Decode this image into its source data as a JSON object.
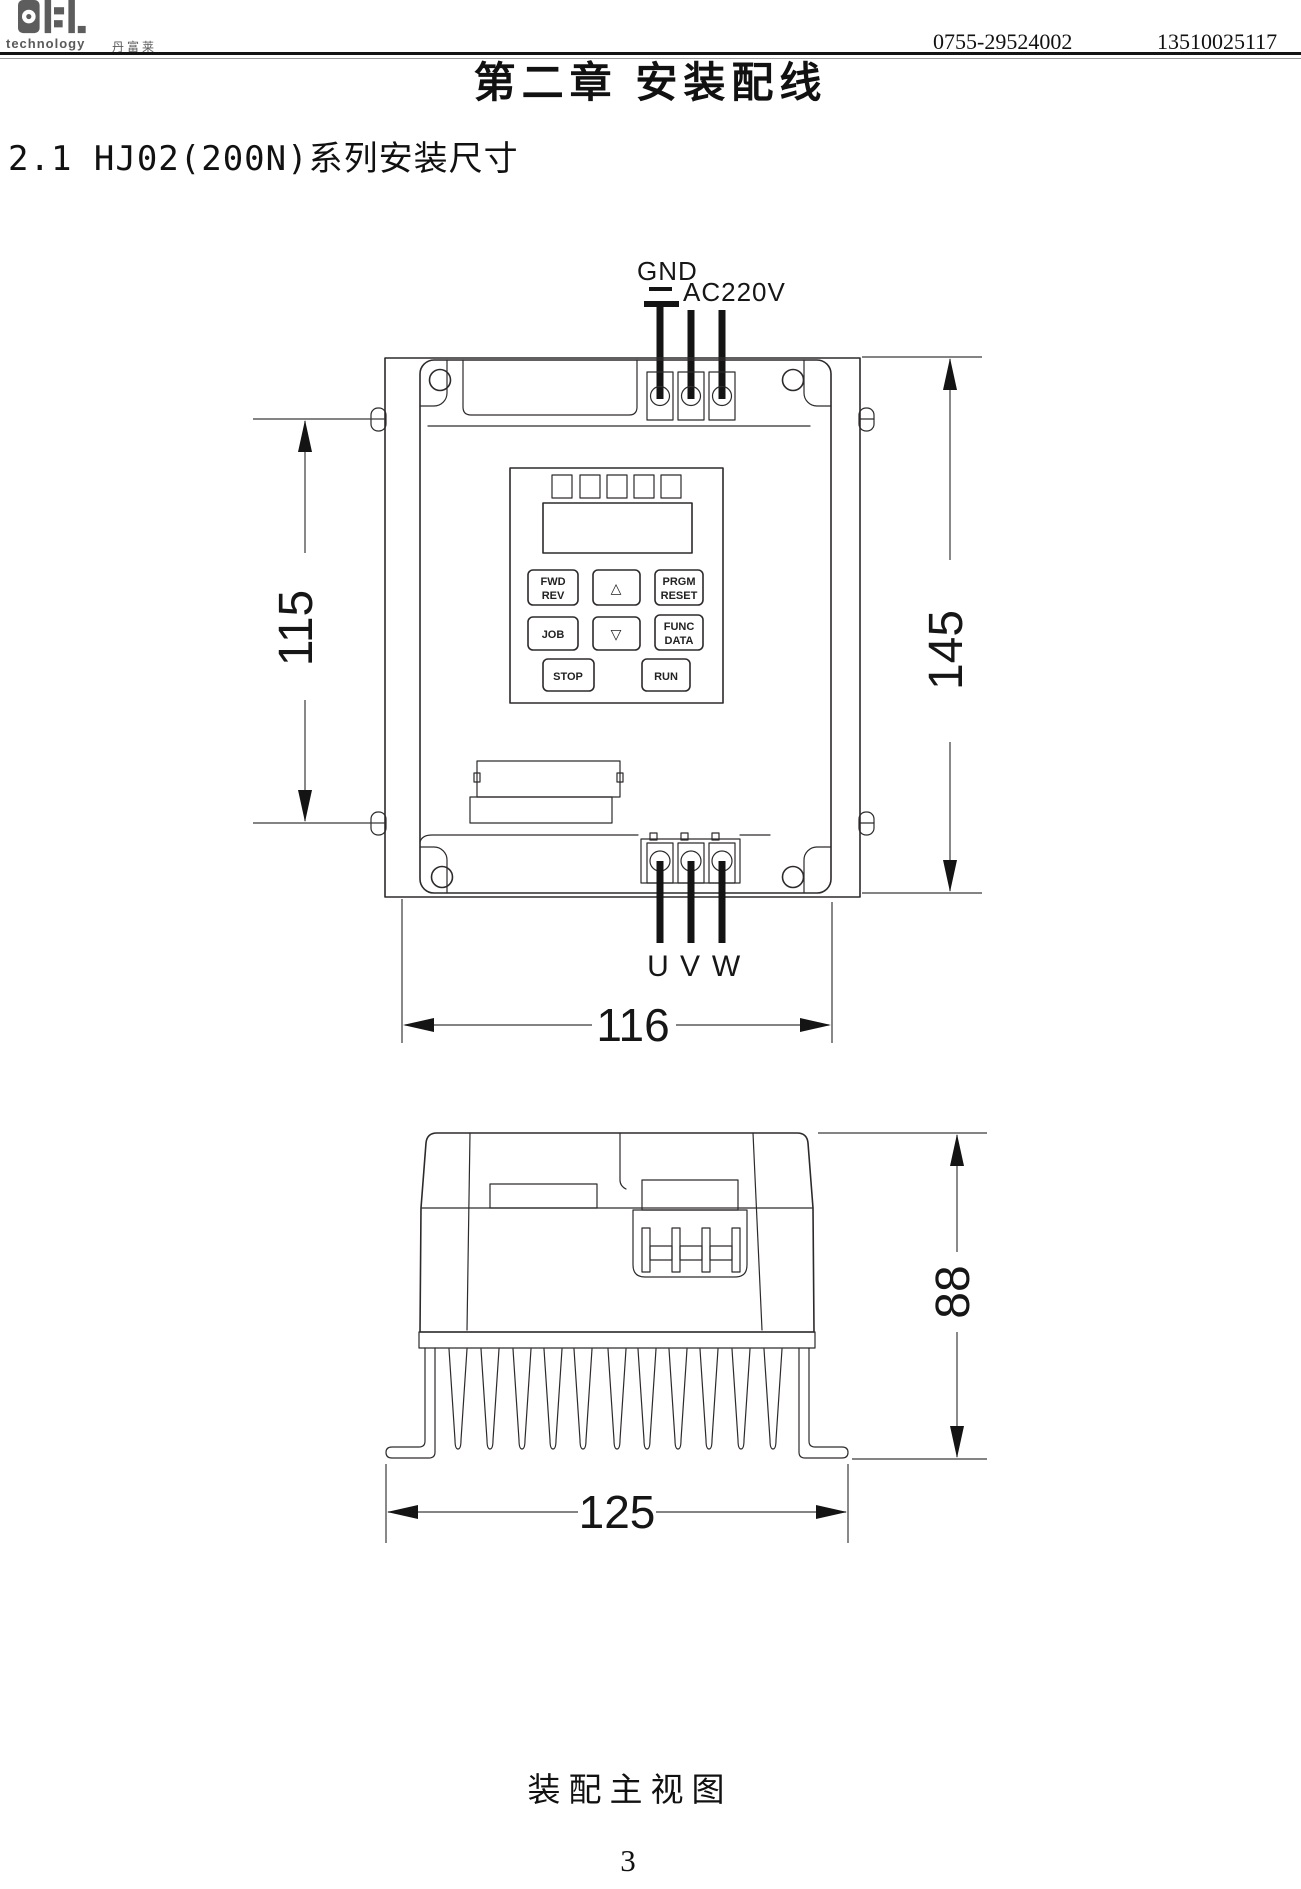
{
  "header": {
    "logo": {
      "main": "DFL",
      "sub": "technology",
      "cn": "丹富莱"
    },
    "phone_left": "0755-29524002",
    "phone_right": "13510025117"
  },
  "chapter_title": "第二章 安装配线",
  "section_title": "2.1 HJ02(200N)系列安装尺寸",
  "front_view": {
    "gnd_label": "GND",
    "ac_label": "AC220V",
    "output_labels": {
      "u": "U",
      "v": "V",
      "w": "W"
    },
    "dims": {
      "inner_height": "115",
      "outer_height": "145",
      "width": "116"
    },
    "keypad": {
      "fwd": "FWD",
      "rev": "REV",
      "up": "△",
      "prgm": "PRGM",
      "reset": "RESET",
      "job": "JOB",
      "down": "▽",
      "func": "FUNC",
      "data": "DATA",
      "stop": "STOP",
      "run": "RUN"
    }
  },
  "side_view": {
    "dims": {
      "height": "88",
      "width": "125"
    }
  },
  "caption": "装配主视图",
  "page_number": "3"
}
